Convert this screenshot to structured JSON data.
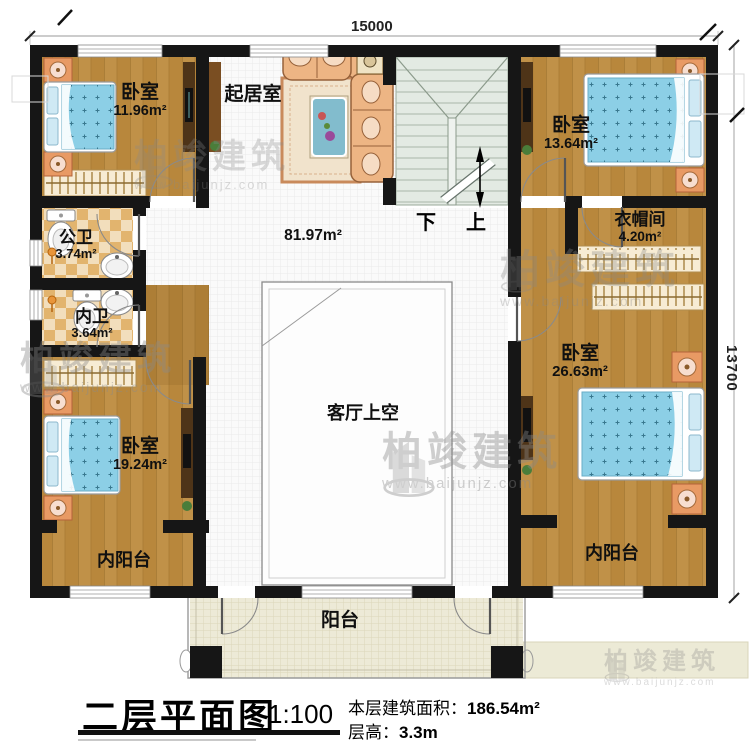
{
  "drawing": {
    "type": "floor-plan",
    "floor": "second"
  },
  "rooms": {
    "bedroom_tl": {
      "name": "卧室",
      "area": "11.96m²"
    },
    "living": {
      "name": "起居室"
    },
    "bedroom_tr": {
      "name": "卧室",
      "area": "13.64m²"
    },
    "cloakroom": {
      "name": "衣帽间",
      "area": "4.20m²"
    },
    "bath_public": {
      "name": "公卫",
      "area": "3.74m²"
    },
    "bath_private": {
      "name": "内卫",
      "area": "3.64m²"
    },
    "hall": {
      "area": "81.97m²"
    },
    "void": {
      "name": "客厅上空"
    },
    "bedroom_right": {
      "name": "卧室",
      "area": "26.63m²"
    },
    "bedroom_bl": {
      "name": "卧室",
      "area": "19.24m²"
    },
    "inner_balcony_left": {
      "name": "内阳台"
    },
    "inner_balcony_right": {
      "name": "内阳台"
    },
    "balcony": {
      "name": "阳台"
    }
  },
  "stairs": {
    "down_label": "下",
    "up_label": "上"
  },
  "dimensions": {
    "width_mm": "15000",
    "depth_mm": "13700"
  },
  "title_block": {
    "title": "二层平面图",
    "scale": "1:100",
    "area_label": "本层建筑面积：",
    "area_value": "186.54m²",
    "floor_height_label": "层高：",
    "floor_height_value": "3.3m"
  },
  "watermark": {
    "brand": "柏竣建筑",
    "url": "www.baijunjz.com"
  },
  "icons": {
    "watermark_logo": "building-logo"
  },
  "colors": {
    "wall": "#161616",
    "wood_floor": "#b8873c",
    "tile_floor": "#fafafa",
    "bath_tile": "#e2b46e",
    "stair": "#e3eae3",
    "balcony_floor": "#edead7",
    "bed_blanket": "#8ccfe6",
    "sofa": "#edb584",
    "nightstand": "#e89a64"
  }
}
